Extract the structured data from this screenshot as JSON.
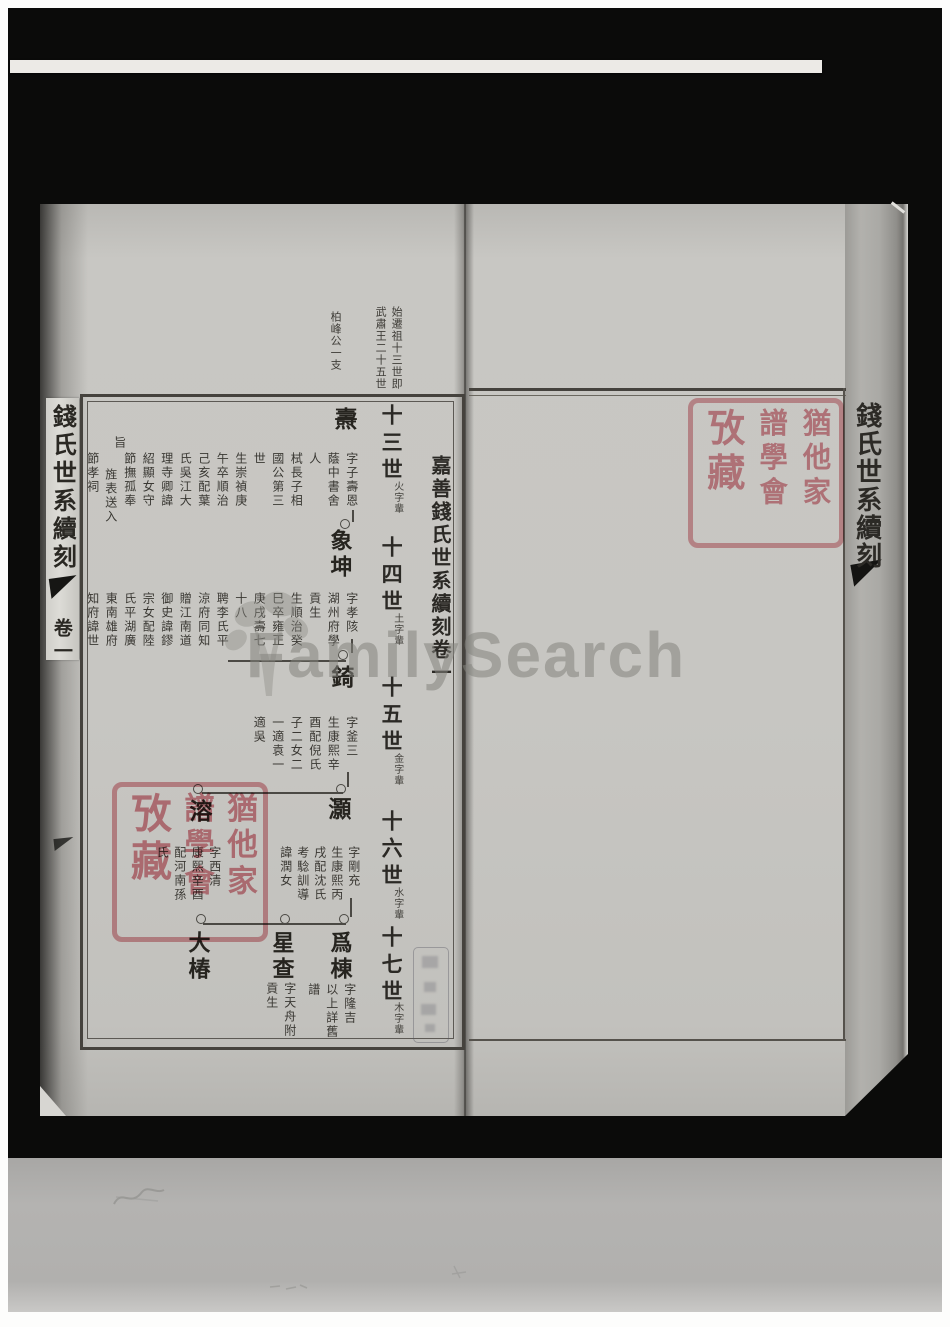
{
  "source_watermark": {
    "brand": "FamilySearch"
  },
  "library_seal": {
    "text": "猶他家譜學會攷藏",
    "columns": [
      "猶他家",
      "譜學會",
      "攷藏"
    ],
    "color": "#ce5c6a"
  },
  "book": {
    "spine_title": "錢氏世系續刻",
    "spine_volume": "卷一",
    "edge_title": "錢氏世系續刻",
    "margin_notes": [
      "始遷祖十三世即",
      "武肅王二十五世",
      "柏峰公一支"
    ],
    "page_title": "嘉善錢氏世系續刻卷一",
    "generations": [
      {
        "label": "十三世",
        "note": "火字輩"
      },
      {
        "label": "十四世",
        "note": "土字輩"
      },
      {
        "label": "十五世",
        "note": "金字輩"
      },
      {
        "label": "十六世",
        "note": "水字輩"
      },
      {
        "label": "十七世",
        "note": "木字輩"
      }
    ],
    "entries": [
      {
        "name": "燾",
        "bio": [
          "字子壽恩",
          "蔭中書舍",
          "人",
          "栻長子相",
          "國公第三",
          "世",
          "生崇禎庚",
          "午卒順治",
          "己亥配葉",
          "氏吳江大",
          "理寺卿諱",
          "紹顯女守",
          "節撫孤奉",
          "旨",
          "旌表送入",
          "節孝祠"
        ]
      },
      {
        "name": "象坤",
        "bio": [
          "字孝陔",
          "湖州府學",
          "貢生",
          "生順治癸",
          "巳卒雍正",
          "庚戌壽七",
          "十八",
          "聘李氏平",
          "涼府同知",
          "贈江南道",
          "御史諱鏐",
          "宗女配陸",
          "氏平湖廣",
          "東南雄府",
          "知府諱世"
        ]
      },
      {
        "name": "錡",
        "bio": [
          "字釜三",
          "生康熙辛",
          "酉配倪氏",
          "子二女二",
          "一適袁一",
          "適吳"
        ]
      },
      {
        "name": "灝",
        "bio": [
          "字剛充",
          "生康熙丙",
          "戌配沈氏",
          "考騐訓導",
          "諱潤女"
        ]
      },
      {
        "name": "溶",
        "bio": [
          "字西清",
          "康熙辛酉",
          "配河南孫",
          "氏"
        ]
      },
      {
        "name": "爲棟",
        "bio": [
          "字隆吉",
          "以上詳舊",
          "譜"
        ]
      },
      {
        "name": "星查",
        "bio": [
          "字天舟附",
          "貢生"
        ]
      },
      {
        "name": "大椿",
        "bio": []
      }
    ]
  }
}
